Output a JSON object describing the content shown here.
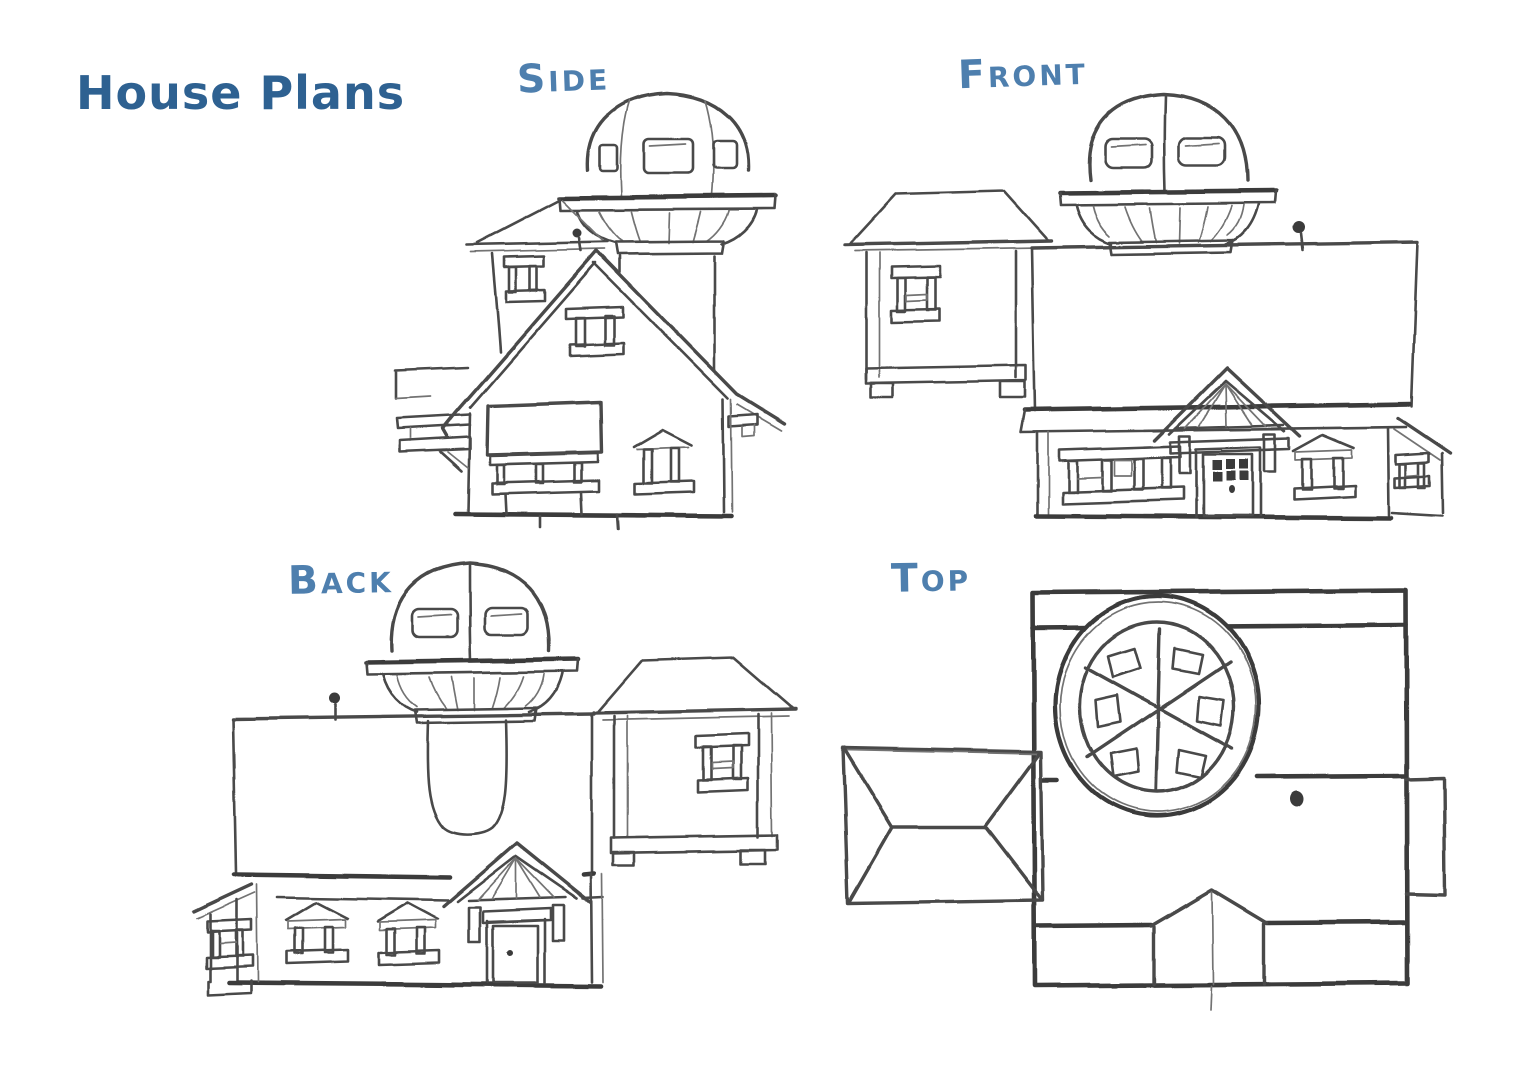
{
  "page": {
    "title": "House Plans",
    "background": "#ffffff"
  },
  "colors": {
    "title": "#2e6191",
    "label": "#4e7fae",
    "ink": "#4a4a4a",
    "ink_dark": "#3a3a3a",
    "ink_light": "#737373",
    "paper": "#ffffff"
  },
  "views": [
    {
      "id": "side",
      "label": "SIDE"
    },
    {
      "id": "front",
      "label": "FRONT"
    },
    {
      "id": "back",
      "label": "BACK"
    },
    {
      "id": "top",
      "label": "TOP"
    }
  ]
}
